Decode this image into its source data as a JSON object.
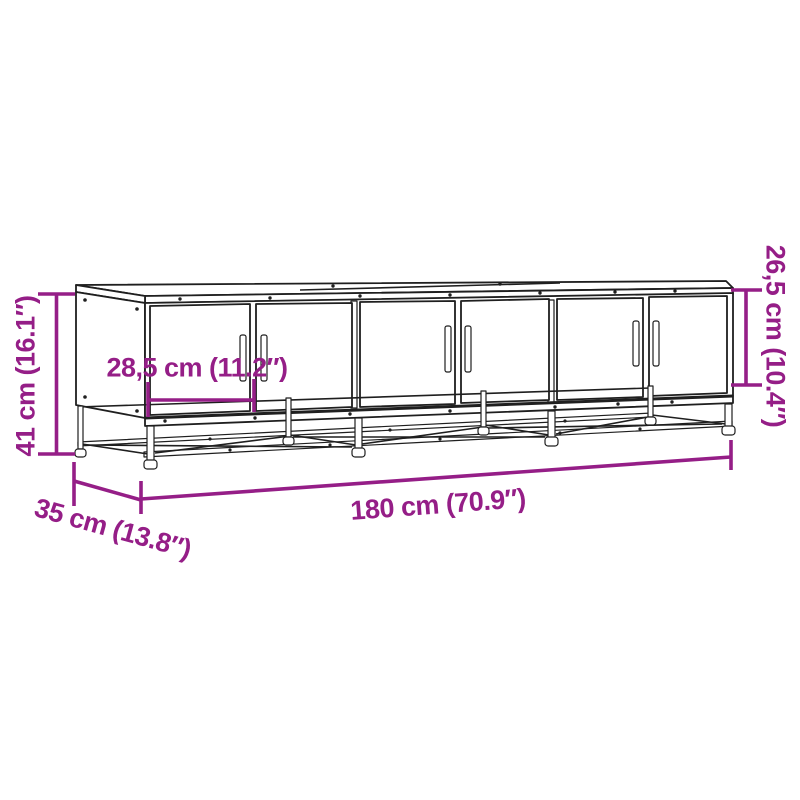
{
  "diagram": {
    "subject": "TV cabinet line drawing: three door sections (six doors with vertical handles) on an open metal base frame with cross bracing",
    "accent_color": "#951e87",
    "line_color": "#1f1f1f",
    "background_color": "#ffffff",
    "dimensions": [
      {
        "id": "overall-height",
        "label": "41 cm (16.1″)",
        "cm": "41",
        "inches": "16.1",
        "placement": "vertical-left"
      },
      {
        "id": "door-width",
        "label": "28,5 cm (11.2″)",
        "cm": "28,5",
        "inches": "11.2",
        "placement": "horizontal-on-door"
      },
      {
        "id": "door-height",
        "label": "26,5 cm (10.4″)",
        "cm": "26,5",
        "inches": "10.4",
        "placement": "vertical-right"
      },
      {
        "id": "overall-width",
        "label": "180 cm (70.9″)",
        "cm": "180",
        "inches": "70.9",
        "placement": "horizontal-bottom"
      },
      {
        "id": "overall-depth",
        "label": "35 cm (13.8″)",
        "cm": "35",
        "inches": "13.8",
        "placement": "diagonal-bottom-left"
      }
    ],
    "drawing": {
      "sections": 3,
      "doors": 6,
      "handles": 6,
      "style": "black outline on white"
    }
  }
}
